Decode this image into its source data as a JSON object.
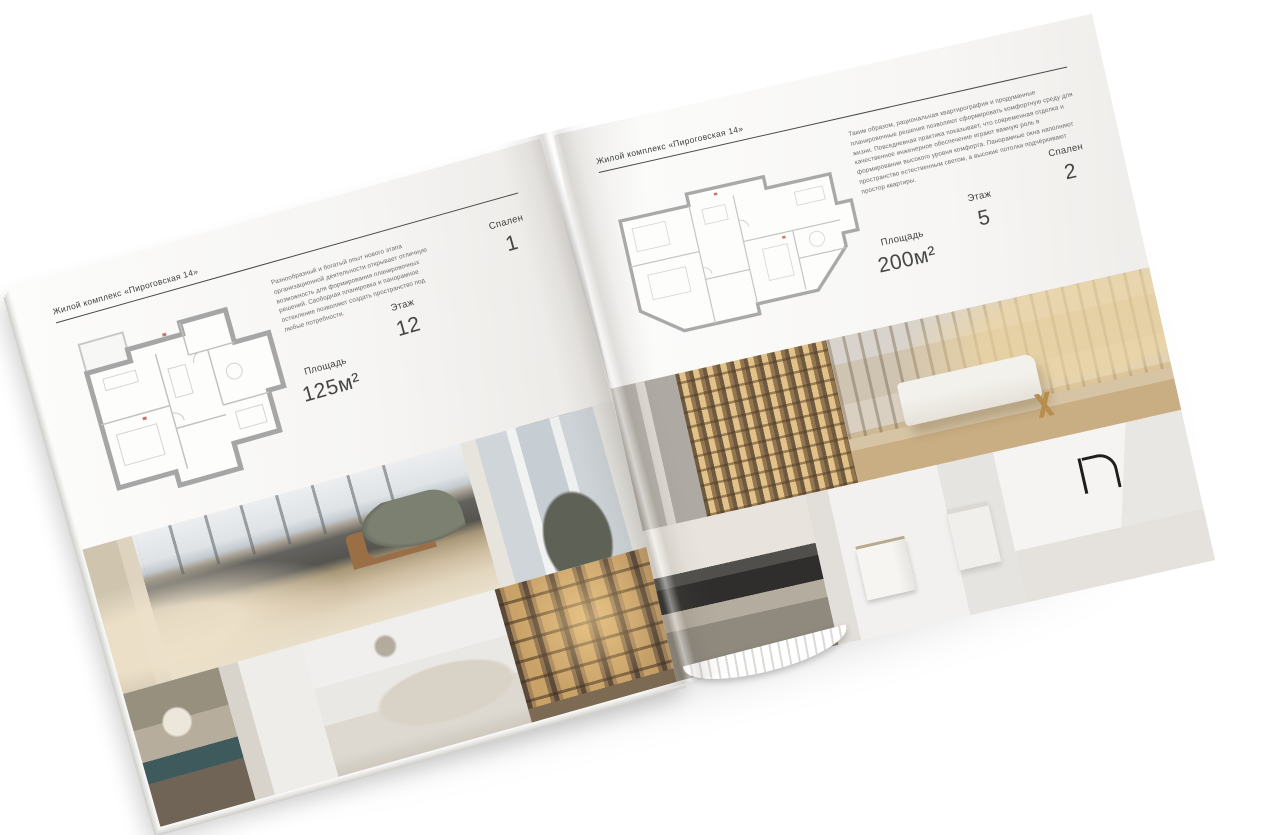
{
  "colors": {
    "background": "#ffffff",
    "page": "#f6f5f3",
    "text": "#3e3e3e",
    "rule": "#4a4a4a",
    "plan_walls": "#a6a6a6",
    "wood_accent": "#c9a268",
    "teal_accent": "#3f5a5c"
  },
  "brochure": {
    "left_page": {
      "header": "Жилой комплекс «Пироговская 14»",
      "description": "Разнообразный и богатый опыт нового этапа организационной деятельности открывает отличную возможность для формирования планировочных решений. Свободная планировка и панорамное остекление позволяют создать пространство под любые потребности.",
      "stats": [
        {
          "label": "Площадь",
          "value": "125м²"
        },
        {
          "label": "Этаж",
          "value": "12"
        },
        {
          "label": "Спален",
          "value": "1"
        }
      ],
      "photos": [
        "bedroom-city-view-panorama",
        "window-armchair",
        "console-with-flowers",
        "white-bedroom",
        "bookshelf-corridor"
      ]
    },
    "right_page": {
      "header": "Жилой комплекс «Пироговская 14»",
      "description": "Таким образом, рациональная квартирография и продуманные планировочные решения позволяют сформировать комфортную среду для жизни. Повседневная практика показывает, что современная отделка и качественное инженерное обеспечение играют важную роль в формировании высокого уровня комфорта. Панорамные окна наполняют пространство естественным светом, а высокие потолки подчёркивают простор квартиры.",
      "stats": [
        {
          "label": "Площадь",
          "value": "200м²"
        },
        {
          "label": "Этаж",
          "value": "5"
        },
        {
          "label": "Спален",
          "value": "2"
        }
      ],
      "photos": [
        "illuminated-wardrobe-hallway",
        "study-with-desk",
        "kitchen-cooktop",
        "bathroom",
        "kitchen-island-faucet"
      ]
    }
  }
}
